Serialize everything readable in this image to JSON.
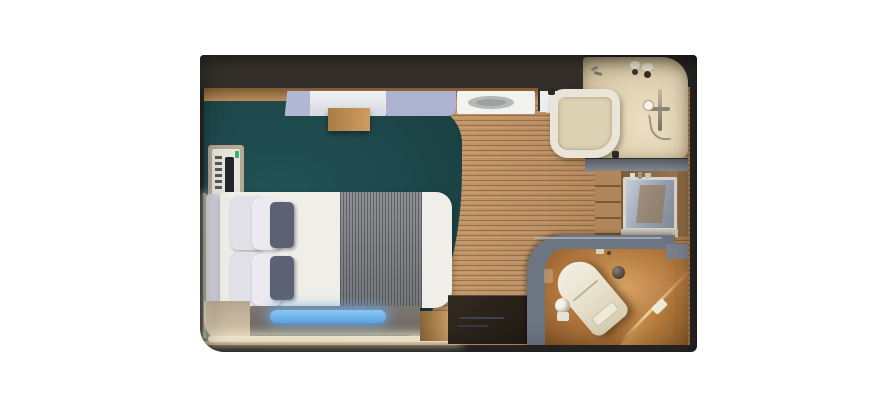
{
  "page": {
    "background": "#ffffff",
    "title": "Stateroom floor plan render"
  },
  "floorplan": {
    "label": "Cruise-ship stateroom top-down 3D floor plan",
    "palette": {
      "wall_charcoal": "#2b2826",
      "wood_floor": "#b98e62",
      "carpet_teal": "#1d4649",
      "shower_floor_cream": "#e6dcc2",
      "toilet_floor_amber": "#c08849",
      "partition_slate": "#6c7582",
      "bed_linen_white": "#efeee8",
      "runner_gray": "#83878a",
      "accent_pillow_slate": "#5c6274",
      "bench_glow_blue": "#6db3ea",
      "cove_light_warm": "#f9efd6",
      "overhead_panel_lavender": "#b2b7d4"
    },
    "areas": {
      "room": {
        "label": "Stateroom outline with dark walls"
      },
      "carpet": {
        "label": "Teal carpet under sleeping area with curved edge"
      },
      "wood": {
        "label": "Light oak plank flooring"
      },
      "bed": {
        "label": "Double bed with white duvet, pillows and gray runner"
      },
      "pillows": {
        "label": "White pillows with slate accent pillows"
      },
      "bench": {
        "label": "Foot bench with illuminated blue cushion"
      },
      "cove": {
        "label": "Warm cove lighting along wall base"
      },
      "phone": {
        "label": "Wall-mounted phone / control panel"
      },
      "overhead": {
        "label": "Overhead shelf, wood box and ceiling light"
      },
      "shower": {
        "label": "Shower room with basin, glass screen and hand shower"
      },
      "wardrobe": {
        "label": "Wardrobe / vanity with mirror and shelves"
      },
      "toilet": {
        "label": "Toilet room behind curved slate partition"
      },
      "entry": {
        "label": "Entry area with dark door mat"
      }
    }
  }
}
